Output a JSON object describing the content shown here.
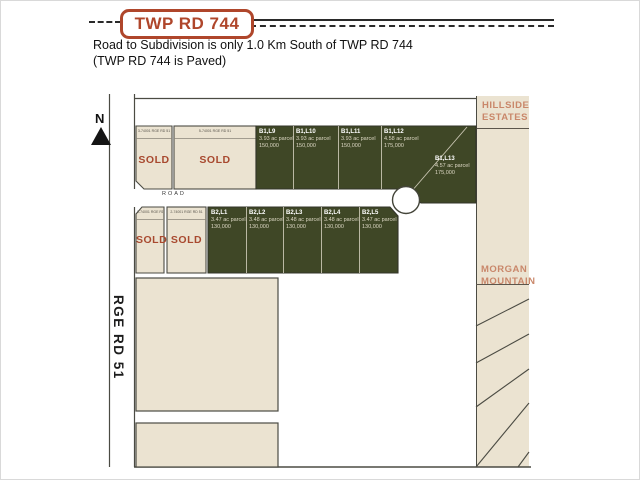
{
  "header": {
    "road_badge": "TWP RD 744",
    "subtitle_line1": "Road to Subdivision is only 1.0 Km South of TWP RD 744",
    "subtitle_line2": "(TWP RD 744 is Paved)"
  },
  "map": {
    "north_label": "N",
    "rge_rd_label": "RGE RD 51",
    "road_label": "ROAD",
    "hillside_label": "HILLSIDE ESTATES",
    "morgan_label": "MORGAN MOUNTAIN",
    "sold_row1": [
      {
        "address": "3-74001 RGE RD 51",
        "status": "SOLD"
      },
      {
        "address": "5-74001 RGE RD 51",
        "status": "SOLD"
      }
    ],
    "sold_row2": [
      {
        "address": "1-74001 RGE RD 51",
        "status": "SOLD"
      },
      {
        "address": "2-74001 RGE RD 51",
        "status": "SOLD"
      }
    ],
    "block_b1": [
      {
        "name": "B1,L9",
        "size": "3.93 ac parcel",
        "price": "150,000"
      },
      {
        "name": "B1,L10",
        "size": "3.93 ac parcel",
        "price": "150,000"
      },
      {
        "name": "B1,L11",
        "size": "3.93 ac parcel",
        "price": "150,000"
      },
      {
        "name": "B1,L12",
        "size": "4.58 ac parcel",
        "price": "175,000"
      },
      {
        "name": "B1,L13",
        "size": "4.57 ac parcel",
        "price": "175,000"
      }
    ],
    "block_b2": [
      {
        "name": "B2,L1",
        "size": "3.47 ac parcel",
        "price": "130,000"
      },
      {
        "name": "B2,L2",
        "size": "3.48 ac parcel",
        "price": "130,000"
      },
      {
        "name": "B2,L3",
        "size": "3.48 ac parcel",
        "price": "130,000"
      },
      {
        "name": "B2,L4",
        "size": "3.48 ac parcel",
        "price": "130,000"
      },
      {
        "name": "B2,L5",
        "size": "3.47 ac parcel",
        "price": "130,000"
      }
    ]
  },
  "colors": {
    "parcel_green": "#3F4726",
    "lot_beige": "#EBE3D1",
    "accent_red": "#A8492F",
    "badge_red": "#AF462B",
    "label_tan": "#C9876A",
    "line_dark": "#4B4B43"
  }
}
